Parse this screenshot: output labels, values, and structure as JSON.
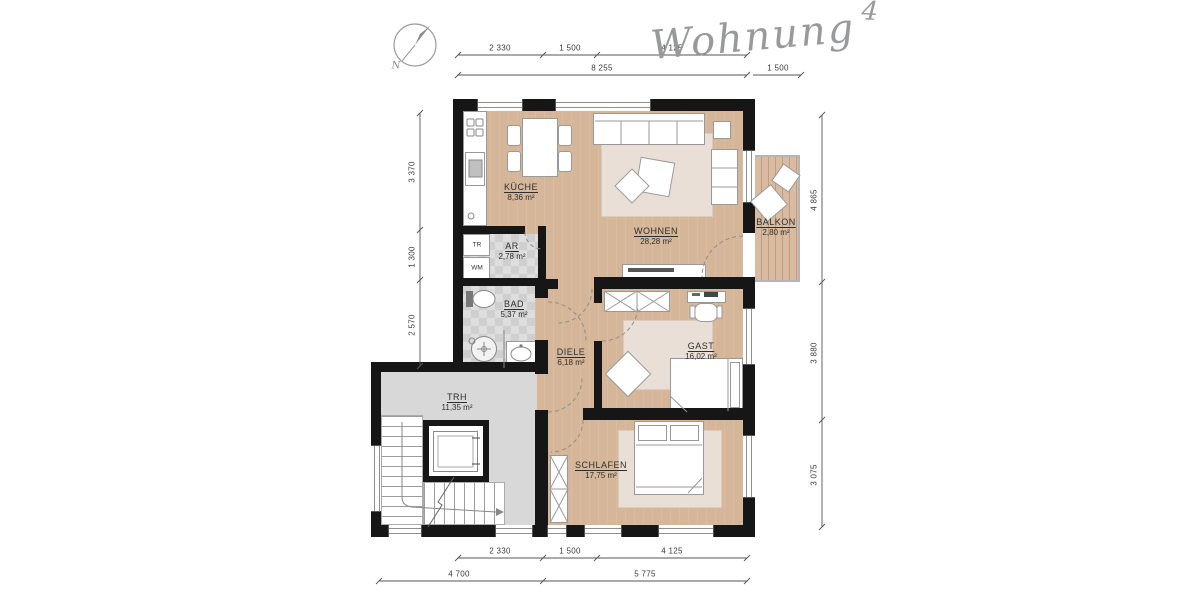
{
  "title": {
    "word": "Wohnung",
    "number": "4"
  },
  "compass_label": "N",
  "rooms": {
    "kueche": {
      "name": "KÜCHE",
      "area": "8,36 m²"
    },
    "wohnen": {
      "name": "WOHNEN",
      "area": "28,28 m²"
    },
    "balkon": {
      "name": "BALKON",
      "area": "2,80 m²"
    },
    "ar": {
      "name": "AR",
      "area": "2,78 m²"
    },
    "bad": {
      "name": "BAD",
      "area": "5,37 m²"
    },
    "diele": {
      "name": "DIELE",
      "area": "6,18 m²"
    },
    "gast": {
      "name": "GAST",
      "area": "16,02 m²"
    },
    "trh": {
      "name": "TRH",
      "area": "11,35 m²"
    },
    "schlafen": {
      "name": "SCHLAFEN",
      "area": "17,75 m²"
    }
  },
  "appliances": {
    "dryer": "TR",
    "washer": "WM"
  },
  "dimensions": {
    "top_row1": [
      "2 330",
      "1 500",
      "4 125"
    ],
    "top_row2": [
      "8 255",
      "1 500"
    ],
    "bottom_row1": [
      "2 330",
      "1 500",
      "4 125"
    ],
    "bottom_row2": [
      "4 700",
      "5 775"
    ],
    "left": [
      "3 370",
      "1 300",
      "2 570"
    ],
    "right": [
      "4 865",
      "3 880",
      "3 075"
    ]
  },
  "colors": {
    "wall": "#161616",
    "wood_floor": "#d5b698",
    "rug": "#eadfd6",
    "tile_floor": "#d6d6d6",
    "stair_floor": "#d8d8d8",
    "deck": "#d8bba0",
    "lineart": "#8a8a8a"
  }
}
